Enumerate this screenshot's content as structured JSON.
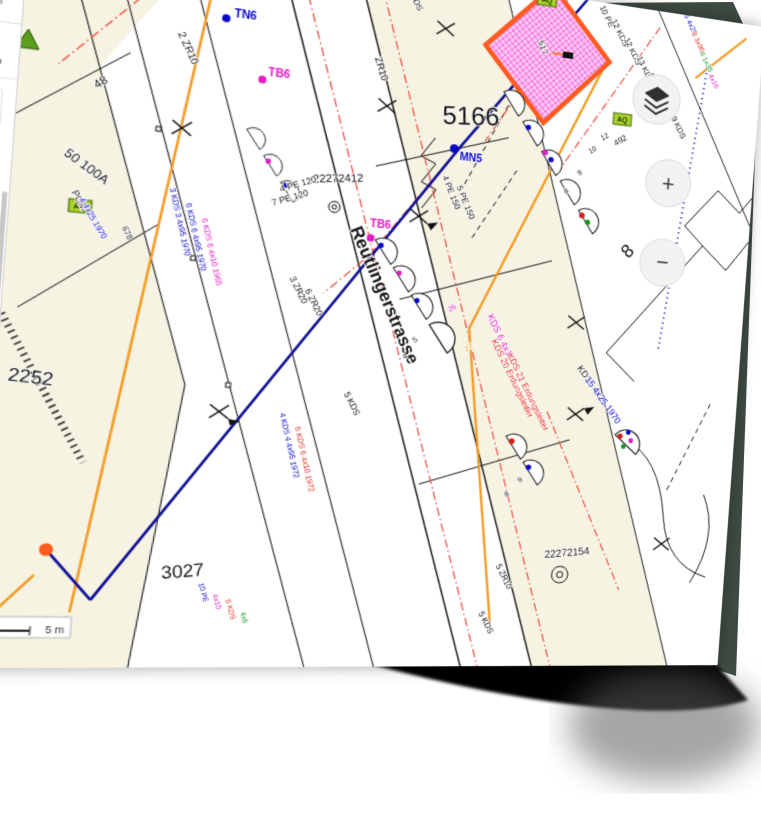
{
  "app": {
    "backdrop_color": "#3d4a41",
    "shadow_color": "#000000"
  },
  "sidebar": {
    "items": [
      {
        "name": "search"
      },
      {
        "name": "properties",
        "active": true
      },
      {
        "name": "layers"
      },
      {
        "name": "measure"
      },
      {
        "name": "legend"
      },
      {
        "name": "lock"
      },
      {
        "name": "archive"
      },
      {
        "name": "user"
      },
      {
        "name": "settings"
      }
    ]
  },
  "panel": {
    "search": {
      "placeholder": "Suchen"
    },
    "tabs": [
      {
        "label": "Eigenschaften",
        "active": true
      },
      {
        "label": "Klonen",
        "active": true
      },
      {
        "label": "Verbinden",
        "active": false
      }
    ],
    "ops": [
      {
        "label": "Abwählen"
      },
      {
        "label": "Verschieben"
      },
      {
        "label": "Aktualisieren"
      }
    ],
    "style_buttons_row1": [
      "marker-red",
      "text-blue-selected",
      "flag-blue",
      "pen-line"
    ],
    "style_buttons_row2": [
      "style-1",
      "style-2",
      "style-3-selected",
      "style-4",
      "style-5",
      "style-6",
      "style-7",
      "style-8"
    ],
    "context_caption": "NETZINFORMATION (A-40) ELEKTRIZITÄTSVERSORGUNG (STROM)",
    "buttons": [
      {
        "label": "Zurücksetzen"
      },
      {
        "label": "Kabel anlegen"
      }
    ],
    "fields": [
      {
        "label": "Kabeltyp *",
        "value": "325/25 [ACC Rundsteuerung]",
        "dropdown": true
      },
      {
        "label": "Hausanschluss *",
        "value": "HAS12300 [BCA Verwaltungsleitung]",
        "dropdown": true
      },
      {
        "label": "Werkstoff *",
        "value": "ST 32/B - B",
        "dropdown": true
      },
      {
        "label": "Länge [m] *",
        "value": "65.81 m",
        "dropdown": false
      }
    ],
    "checkboxes": [
      {
        "label_prefix": "Beteiligte Zugänge ",
        "label_bold": "anzeigen",
        "checked": false
      },
      {
        "label_prefix": "Freie Felder ",
        "label_bold": "anzeigen",
        "checked": false
      }
    ]
  },
  "map": {
    "scale_label": "5 m",
    "zoom_in_label": "+",
    "zoom_out_label": "−",
    "palette": {
      "cable_blue": "#0808c8",
      "cable_magenta": "#e01ec4",
      "cable_red": "#e22c20",
      "cable_green": "#14961e",
      "line_orange": "#f59a23",
      "diamond_fill": "#ffc4f4",
      "diamond_border": "#ff5a1f",
      "badge_green": "#abd12d",
      "dot_orange": "#ff5a1f"
    },
    "badges": [
      {
        "text": "AQ",
        "x": 438,
        "y": 0
      },
      {
        "text": "AQ",
        "x": 520,
        "y": 104
      },
      {
        "text": "AQ",
        "x": 46,
        "y": 236
      }
    ],
    "labels": [
      {
        "t": "3026",
        "x": 60,
        "y": 22,
        "r": 32,
        "c": "k",
        "s": 15
      },
      {
        "t": "48",
        "x": 66,
        "y": 136,
        "r": -38,
        "c": "k",
        "s": 10
      },
      {
        "t": "50 100A",
        "x": 56,
        "y": 210,
        "r": 33,
        "c": "k",
        "s": 11
      },
      {
        "t": "678",
        "x": 92,
        "y": 262,
        "r": 62,
        "c": "k",
        "s": 7
      },
      {
        "t": "2252",
        "x": 26,
        "y": 396,
        "r": 4,
        "c": "k",
        "s": 16
      },
      {
        "t": "3027",
        "x": 160,
        "y": 560,
        "r": -6,
        "c": "k",
        "s": 16
      },
      {
        "t": "5166",
        "x": 384,
        "y": 132,
        "r": -5,
        "c": "k",
        "s": 24
      },
      {
        "t": "8",
        "x": 548,
        "y": 240,
        "r": -48,
        "c": "k",
        "s": 18
      },
      {
        "t": "492",
        "x": 530,
        "y": 132,
        "r": -36,
        "c": "k",
        "s": 8
      },
      {
        "t": "22272412",
        "x": 268,
        "y": 198,
        "r": -7,
        "c": "k",
        "s": 10
      },
      {
        "t": "22272154",
        "x": 506,
        "y": 534,
        "r": -6,
        "c": "k",
        "s": 10
      },
      {
        "t": "Reutlingerstrasse",
        "x": 312,
        "y": 300,
        "r": 63,
        "c": "k",
        "s": 16,
        "b": 1
      },
      {
        "t": "MN5",
        "x": 386,
        "y": 166,
        "r": 0,
        "c": "b",
        "s": 10,
        "b": 1
      },
      {
        "t": "TN6",
        "x": 178,
        "y": 62,
        "r": 0,
        "c": "b",
        "s": 10,
        "b": 1
      },
      {
        "t": "TB6",
        "x": 210,
        "y": 110,
        "r": 0,
        "c": "m",
        "s": 10,
        "b": 1
      },
      {
        "t": "TB6",
        "x": 308,
        "y": 236,
        "r": 0,
        "c": "m",
        "s": 10,
        "b": 1
      },
      {
        "t": "2 ZR10",
        "x": 130,
        "y": 96,
        "r": 62,
        "c": "k",
        "s": 9
      },
      {
        "t": "ZR10",
        "x": 296,
        "y": 92,
        "r": 68,
        "c": "k",
        "s": 9
      },
      {
        "t": "3 ZR20",
        "x": 238,
        "y": 300,
        "r": 60,
        "c": "k",
        "s": 8
      },
      {
        "t": "6 ZR20",
        "x": 252,
        "y": 310,
        "r": 60,
        "c": "k",
        "s": 8
      },
      {
        "t": "2 KDS",
        "x": 322,
        "y": 24,
        "r": 60,
        "c": "k",
        "s": 8
      },
      {
        "t": "10 PE",
        "x": 504,
        "y": 14,
        "r": 58,
        "c": "k",
        "s": 8
      },
      {
        "t": "12 KDS",
        "x": 518,
        "y": 28,
        "r": 58,
        "c": "k",
        "s": 8
      },
      {
        "t": "12 KDS",
        "x": 532,
        "y": 44,
        "r": 58,
        "c": "k",
        "s": 8
      },
      {
        "t": "13 KDS",
        "x": 546,
        "y": 60,
        "r": 58,
        "c": "k",
        "s": 8
      },
      {
        "t": "15 KDS",
        "x": 559,
        "y": 76,
        "r": 58,
        "c": "k",
        "s": 9
      },
      {
        "t": "8 KDS",
        "x": 572,
        "y": 95,
        "r": 58,
        "c": "k",
        "s": 8
      },
      {
        "t": "9 KDS",
        "x": 584,
        "y": 112,
        "r": 58,
        "c": "k",
        "s": 8
      },
      {
        "t": "15 4x25",
        "x": 588,
        "y": 8,
        "r": 58,
        "c": "b",
        "s": 7
      },
      {
        "t": "8 3x95",
        "x": 598,
        "y": 26,
        "r": 58,
        "c": "r",
        "s": 7
      },
      {
        "t": "6 1x35",
        "x": 608,
        "y": 44,
        "r": 58,
        "c": "g",
        "s": 7
      },
      {
        "t": "4x16",
        "x": 617,
        "y": 62,
        "r": 58,
        "c": "m",
        "s": 7
      },
      {
        "t": "4 PE 120",
        "x": 234,
        "y": 206,
        "r": -22,
        "c": "k",
        "s": 8
      },
      {
        "t": "7 PE 120",
        "x": 228,
        "y": 219,
        "r": -22,
        "c": "k",
        "s": 8
      },
      {
        "t": "4 PE 150",
        "x": 368,
        "y": 198,
        "r": 64,
        "c": "k",
        "s": 8
      },
      {
        "t": "5 PE 150",
        "x": 382,
        "y": 206,
        "r": 64,
        "c": "k",
        "s": 8
      },
      {
        "t": "PGM",
        "x": 52,
        "y": 238,
        "r": 58,
        "c": "k",
        "s": 8
      },
      {
        "t": "4 4x25 1970",
        "x": 64,
        "y": 252,
        "r": 58,
        "c": "b",
        "s": 7
      },
      {
        "t": "3 KDS 3 4x95 1970",
        "x": 134,
        "y": 248,
        "r": 74,
        "c": "b",
        "s": 7
      },
      {
        "t": "6 KDS 6 4x95 1970",
        "x": 148,
        "y": 260,
        "r": 74,
        "c": "b",
        "s": 7
      },
      {
        "t": "6 KDS 6 4x10 1965",
        "x": 162,
        "y": 272,
        "r": 74,
        "c": "m",
        "s": 7
      },
      {
        "t": "KDS 6 4x10",
        "x": 424,
        "y": 330,
        "r": 60,
        "c": "m",
        "s": 9
      },
      {
        "t": "KDS 20 Erdungsleiter",
        "x": 438,
        "y": 368,
        "r": 60,
        "c": "r",
        "s": 8.5
      },
      {
        "t": "KDS 21 Erdungsleiter",
        "x": 454,
        "y": 380,
        "r": 60,
        "c": "r",
        "s": 8.5
      },
      {
        "t": "KDS",
        "x": 508,
        "y": 360,
        "r": 50,
        "c": "k",
        "s": 9
      },
      {
        "t": "15 4x25 1970",
        "x": 528,
        "y": 384,
        "r": 50,
        "c": "b",
        "s": 9
      },
      {
        "t": "5 KDS",
        "x": 292,
        "y": 400,
        "r": 60,
        "c": "k",
        "s": 8
      },
      {
        "t": "5 KDS",
        "x": 430,
        "y": 600,
        "r": 60,
        "c": "k",
        "s": 8
      },
      {
        "t": "5 ZR10",
        "x": 444,
        "y": 556,
        "r": 60,
        "c": "k",
        "s": 8
      },
      {
        "t": "517",
        "x": 444,
        "y": 52,
        "r": 64,
        "c": "k",
        "s": 8
      },
      {
        "t": "4 KDS 4 4x95 1972",
        "x": 240,
        "y": 440,
        "r": 74,
        "c": "b",
        "s": 7
      },
      {
        "t": "6 KDS 6 4x10 1972",
        "x": 254,
        "y": 452,
        "r": 74,
        "c": "r",
        "s": 7
      },
      {
        "t": "10 PE",
        "x": 176,
        "y": 574,
        "r": 72,
        "c": "b",
        "s": 6.5
      },
      {
        "t": "4x10",
        "x": 188,
        "y": 582,
        "r": 72,
        "c": "m",
        "s": 6.5
      },
      {
        "t": "6 KDS",
        "x": 200,
        "y": 589,
        "r": 72,
        "c": "r",
        "s": 6.5
      },
      {
        "t": "4x6",
        "x": 212,
        "y": 596,
        "r": 72,
        "c": "g",
        "s": 6.5
      },
      {
        "t": "26",
        "x": 380,
        "y": 306,
        "r": -35,
        "c": "m",
        "s": 7
      },
      {
        "t": "27",
        "x": 398,
        "y": 342,
        "r": -35,
        "c": "o",
        "s": 7
      },
      {
        "t": "8",
        "x": 480,
        "y": 186,
        "r": -36,
        "c": "k",
        "s": 7
      },
      {
        "t": "9",
        "x": 492,
        "y": 167,
        "r": -36,
        "c": "k",
        "s": 7
      },
      {
        "t": "10",
        "x": 503,
        "y": 144,
        "r": -36,
        "c": "k",
        "s": 7
      },
      {
        "t": "12",
        "x": 514,
        "y": 130,
        "r": -36,
        "c": "k",
        "s": 7
      },
      {
        "t": "8",
        "x": 444,
        "y": 478,
        "r": -36,
        "c": "k",
        "s": 7
      },
      {
        "t": "9",
        "x": 456,
        "y": 464,
        "r": -36,
        "c": "k",
        "s": 7
      },
      {
        "t": "5",
        "x": 348,
        "y": 338,
        "r": -36,
        "c": "k",
        "s": 7
      },
      {
        "t": "4",
        "x": 340,
        "y": 354,
        "r": -36,
        "c": "k",
        "s": 7
      }
    ]
  }
}
